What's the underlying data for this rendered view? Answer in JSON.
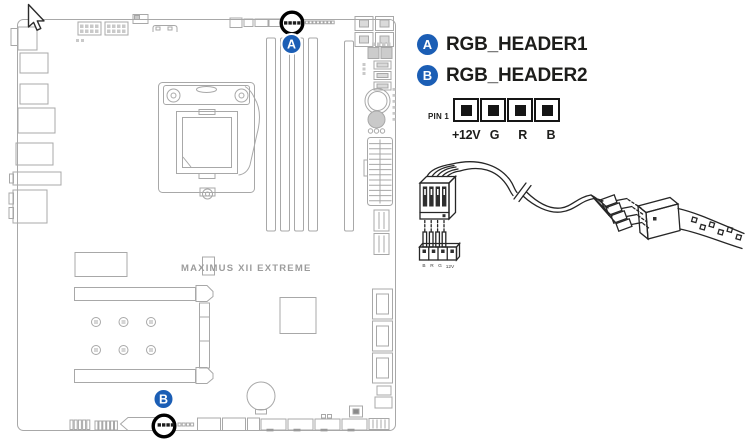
{
  "legend": {
    "items": [
      {
        "marker": "A",
        "label": "RGB_HEADER1"
      },
      {
        "marker": "B",
        "label": "RGB_HEADER2"
      }
    ]
  },
  "pin_diagram": {
    "pin1_label": "PIN 1",
    "pins": [
      "+12V",
      "G",
      "R",
      "B"
    ]
  },
  "board": {
    "name": "MAXIMUS XII EXTREME",
    "marker_a": "A",
    "marker_b": "B"
  },
  "cable_plug": {
    "pin_labels": [
      "B",
      "R",
      "G",
      "12V"
    ]
  },
  "colors": {
    "marker_blue": "#1b5eb5",
    "board_line": "#a8a8a8",
    "highlight_black": "#000000",
    "ink": "#1d1d1b"
  }
}
